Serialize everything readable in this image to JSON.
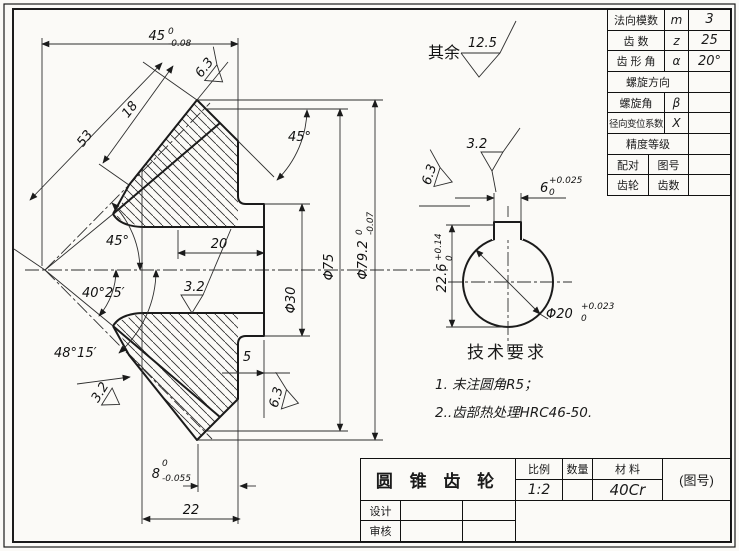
{
  "general_note": {
    "prefix": "其余",
    "roughness": "12.5"
  },
  "param_table": {
    "rows": [
      {
        "label": "法向模数",
        "symbol": "m",
        "value": "3"
      },
      {
        "label": "齿  数",
        "symbol": "z",
        "value": "25"
      },
      {
        "label": "齿 形 角",
        "symbol": "α",
        "value": "20°"
      },
      {
        "label": "螺旋方向",
        "symbol": "",
        "value": ""
      },
      {
        "label": "螺旋角",
        "symbol": "β",
        "value": ""
      },
      {
        "label": "径向变位系数",
        "symbol": "X",
        "value": ""
      },
      {
        "label": "精度等级",
        "symbol": "",
        "value": ""
      },
      {
        "label": "配对",
        "sublabel": "图号",
        "value": ""
      },
      {
        "label": "齿轮",
        "sublabel": "齿数",
        "value": ""
      }
    ]
  },
  "title_block": {
    "title": "圆 锥 齿 轮",
    "scale_label": "比例",
    "scale_value": "1:2",
    "quantity_label": "数量",
    "quantity_value": "",
    "material_label": "材 料",
    "material_value": "40Cr",
    "drawing_no": "(图号)",
    "designer_label": "设计",
    "checker_label": "审核"
  },
  "tech_req": {
    "heading": "技术要求",
    "item1": "1. 未注圆角R5；",
    "item2": "2..齿部热处理HRC46-50."
  },
  "main_view": {
    "dims": {
      "overall_len": {
        "v": "45",
        "sup": "0",
        "sub": "-0.08"
      },
      "cone_dist": "53",
      "face_width": "18",
      "pitch_angle": "45°",
      "back_angle": "45°",
      "root_angle": "40°25′",
      "face_angle": "48°15′",
      "hub_len": "20",
      "boss_len": "5",
      "rim_step": {
        "v": "8",
        "sup": "0",
        "sub": "-0.055"
      },
      "hub_total": "22",
      "dia_hub": "Φ30",
      "dia_outer": "Φ75",
      "dia_tip": {
        "v": "Φ79.2",
        "sup": "0",
        "sub": "-0.07"
      },
      "ra_bore": "3.2",
      "ra_tooth_lower": "3.2",
      "ra_tooth_upper": "6.3",
      "ra_hub_face": "6.3"
    }
  },
  "detail_view": {
    "dims": {
      "key_width": {
        "v": "6",
        "sup": "+0.025",
        "sub": "0"
      },
      "key_depth": {
        "v": "22.6",
        "sup": "+0.14",
        "sub": "0"
      },
      "bore_dia": {
        "v": "Φ20",
        "sup": "+0.023",
        "sub": "0"
      },
      "ra_keyway": "3.2",
      "ra_bore_face": "6.3"
    }
  }
}
